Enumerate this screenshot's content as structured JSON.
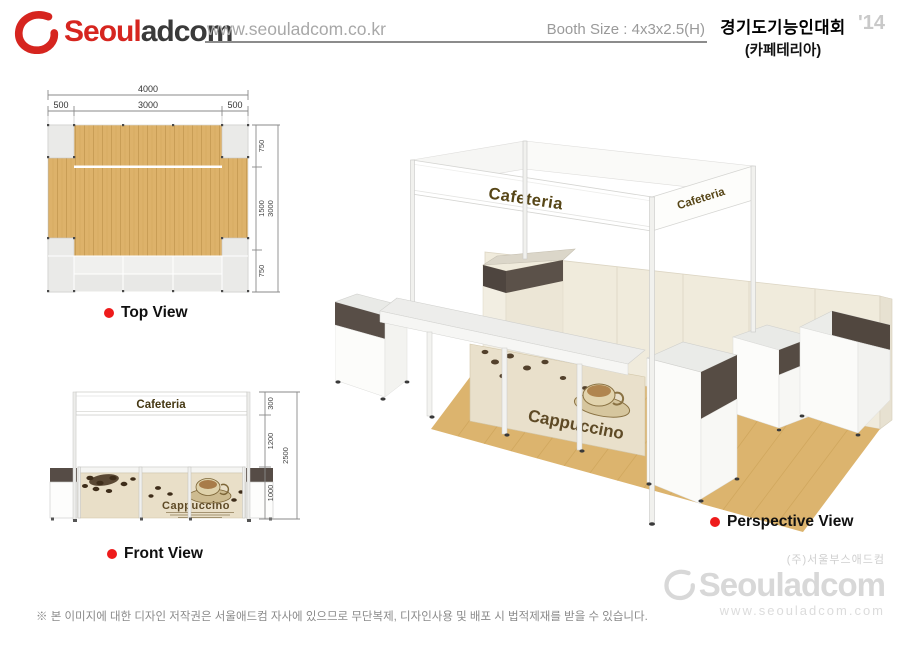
{
  "header": {
    "brand_part1": "Seoul",
    "brand_part2": "adcom",
    "website": "www.seouladcom.co.kr",
    "booth_size": "Booth Size : 4x3x2.5(H)",
    "event_title": "경기도기능인대회",
    "event_subtitle": "(카페테리아)",
    "year": "'14"
  },
  "top_view": {
    "label": "Top View",
    "dim_total_width": "4000",
    "dim_left": "500",
    "dim_center": "3000",
    "dim_right": "500",
    "dim_depth_top": "750",
    "dim_depth_mid": "1500",
    "dim_depth_bottom": "750",
    "dim_total_depth": "3000"
  },
  "front_view": {
    "label": "Front View",
    "sign_text": "Cafeteria",
    "graphic_text": "Cappuccino",
    "dim_sign": "300",
    "dim_wall": "1200",
    "dim_counter": "1000",
    "dim_total_height": "2500"
  },
  "perspective": {
    "label": "Perspective View",
    "sign_front": "Cafeteria",
    "sign_side": "Cafeteria",
    "graphic_text": "Cappuccino"
  },
  "footer": {
    "company_kr": "(주)서울부스애드컴",
    "brand": "Seouladcom",
    "website": "www.seouladcom.com",
    "disclaimer": "※ 본 이미지에 대한 디자인 저작권은 서울애드컴 자사에 있으므로 무단복제, 디자인사용 및 배포 시 법적제재를 받을 수 있습니다."
  },
  "colors": {
    "brand_red": "#d6251f",
    "brand_dark": "#3a3a3a",
    "accent_red": "#ee1b1b",
    "wood": "#ddb26a",
    "dark_panel": "#564c45",
    "cream_wall": "#f0ebdc",
    "sign_text": "#574617"
  }
}
